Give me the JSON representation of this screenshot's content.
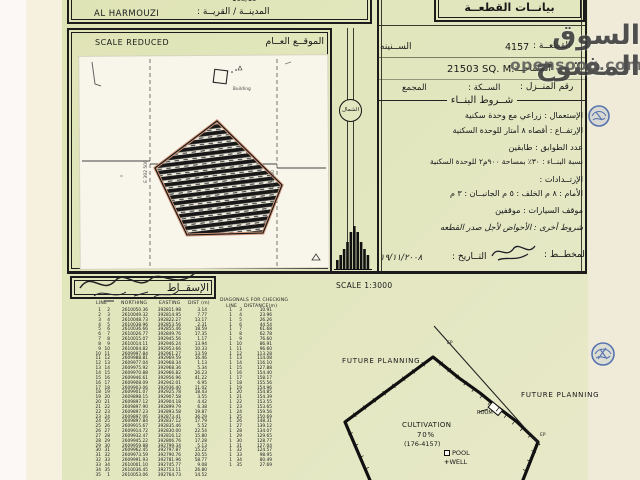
{
  "header_top": {
    "row1": {
      "wilaya_label": "الولايــة :",
      "map_no": "168/19",
      "map_no_label": "رقم الخريطــة :"
    },
    "row2": {
      "town_en": "AL HARMOUZI",
      "town_label": "المدينــة / القريــة :"
    }
  },
  "general_location": {
    "title_en": "SCALE REDUCED",
    "title_ar": "الموقــع العــام",
    "grid_e_left": "E 392 500",
    "grid_e_right": "E 393 000",
    "building_label": "Building"
  },
  "north_label": "الشمال",
  "plot_details": {
    "title": "بيانــات القطعــة",
    "village": "الســنينه",
    "plot_no": "4157",
    "plot_label": "القطعــة :",
    "area_label": "المساحــة :",
    "area_value": "21503 SQ. M.",
    "house_no_label": "رقم المنــزل :",
    "street_label": "الســكة :",
    "complex_label": "المجمع",
    "conditions_title": "شــروط البنــاء",
    "conditions": [
      "الإستعمال : زراعي مع وحدة سكنية",
      "الإرتفــاع : أقصاه ٨ أمتار للوحدة السكنية",
      "عدد الطوابق : طابقين",
      "نسبة البنــاء : ٣٠٪ بمساحة ٩٠٠م٢ للوحدة السكنية",
      "الإرتــدادات :",
      "الأمام : ٨ م    الخلف : ٥ م    الجانبــان : ٣ م",
      "موقف السيارات : موقفين",
      "شروط أخرى : الأحواض لأجل صدر القطعه"
    ],
    "planner_label": "المخطــط :",
    "date_label": "التــاريخ :",
    "date_value": "١٩/١١/٢٠٠٨"
  },
  "coordinates": {
    "title": "الإسقــاط",
    "headers": {
      "line": "LINE",
      "northing": "NORTHING",
      "easting": "EASTING",
      "dist": "DIST (m)",
      "diag_title": "DIAGONALS FOR CHECKING",
      "diag_line": "LINE",
      "diag_dist": "DISTANCE(m)"
    },
    "rows": [
      [
        "1",
        "2",
        "2610050.36",
        "392811.98",
        "3.14"
      ],
      [
        "2",
        "3",
        "2610049.32",
        "392814.95",
        "7.77"
      ],
      [
        "3",
        "4",
        "2610048.73",
        "392822.27",
        "13.17"
      ],
      [
        "4",
        "5",
        "2610038.96",
        "392853.56",
        "2.31"
      ],
      [
        "5",
        "6",
        "2610036.66",
        "392855.46",
        "18.59"
      ],
      [
        "6",
        "7",
        "2610026.77",
        "392849.76",
        "17.35"
      ],
      [
        "7",
        "8",
        "2610015.07",
        "392945.56",
        "1.17"
      ],
      [
        "8",
        "9",
        "2610014.11",
        "392946.24",
        "13.94"
      ],
      [
        "9",
        "10",
        "2610004.82",
        "392953.66",
        "10.33"
      ],
      [
        "10",
        "11",
        "2609997.84",
        "392961.27",
        "13.59"
      ],
      [
        "11",
        "12",
        "2609988.81",
        "392969.59",
        "16.46"
      ],
      [
        "12",
        "13",
        "2609977.04",
        "392968.34",
        "1.13"
      ],
      [
        "13",
        "14",
        "2609975.92",
        "392968.36",
        "5.34"
      ],
      [
        "14",
        "15",
        "2609970.88",
        "392966.82",
        "26.23"
      ],
      [
        "15",
        "16",
        "2609946.61",
        "392956.96",
        "41.22"
      ],
      [
        "16",
        "17",
        "2609908.09",
        "392942.01",
        "6.95"
      ],
      [
        "17",
        "18",
        "2609903.06",
        "392936.40",
        "11.02"
      ],
      [
        "18",
        "19",
        "2609901.07",
        "392925.78",
        "18.43"
      ],
      [
        "19",
        "20",
        "2609898.15",
        "392907.58",
        "3.55"
      ],
      [
        "20",
        "21",
        "2609897.12",
        "392904.18",
        "4.42"
      ],
      [
        "21",
        "22",
        "2609897.90",
        "392899.79",
        "6.38"
      ],
      [
        "22",
        "23",
        "2609897.23",
        "392893.58",
        "19.87"
      ],
      [
        "23",
        "24",
        "2609897.06",
        "392873.41",
        "36.29"
      ],
      [
        "24",
        "25",
        "2609897.84",
        "392837.12",
        "17.79"
      ],
      [
        "25",
        "26",
        "2609915.67",
        "392835.46",
        "5.52"
      ],
      [
        "26",
        "27",
        "2609914.72",
        "392830.00",
        "22.54"
      ],
      [
        "27",
        "28",
        "2609932.47",
        "392816.12",
        "15.80"
      ],
      [
        "28",
        "29",
        "2609945.22",
        "392806.76",
        "17.28"
      ],
      [
        "29",
        "30",
        "2609959.88",
        "392799.34",
        "5.13"
      ],
      [
        "30",
        "31",
        "2609962.45",
        "392797.87",
        "15.22"
      ],
      [
        "31",
        "32",
        "2609973.59",
        "392790.76",
        "20.55"
      ],
      [
        "32",
        "33",
        "2609991.93",
        "392781.96",
        "58.77"
      ],
      [
        "33",
        "34",
        "2610001.10",
        "392745.77",
        "9.08"
      ],
      [
        "34",
        "35",
        "2610036.45",
        "392753.11",
        "26.80"
      ],
      [
        "35",
        "1",
        "2610053.06",
        "392764.73",
        "14.52"
      ]
    ],
    "diagonals": [
      [
        "1",
        "3",
        "10.91"
      ],
      [
        "1",
        "4",
        "23.96"
      ],
      [
        "1",
        "5",
        "26.26"
      ],
      [
        "1",
        "6",
        "44.54"
      ],
      [
        "1",
        "7",
        "61.68"
      ],
      [
        "1",
        "8",
        "62.78"
      ],
      [
        "1",
        "9",
        "76.60"
      ],
      [
        "1",
        "10",
        "86.91"
      ],
      [
        "1",
        "11",
        "96.60"
      ],
      [
        "1",
        "12",
        "113.28"
      ],
      [
        "1",
        "13",
        "114.08"
      ],
      [
        "1",
        "14",
        "116.10"
      ],
      [
        "1",
        "15",
        "127.88"
      ],
      [
        "1",
        "16",
        "154.40"
      ],
      [
        "1",
        "17",
        "158.17"
      ],
      [
        "1",
        "18",
        "155.56"
      ],
      [
        "1",
        "19",
        "154.96"
      ],
      [
        "1",
        "20",
        "154.85"
      ],
      [
        "1",
        "21",
        "154.39"
      ],
      [
        "1",
        "22",
        "153.55"
      ],
      [
        "1",
        "23",
        "153.65"
      ],
      [
        "1",
        "24",
        "159.56"
      ],
      [
        "1",
        "25",
        "150.69"
      ],
      [
        "1",
        "26",
        "148.31"
      ],
      [
        "1",
        "27",
        "139.12"
      ],
      [
        "1",
        "28",
        "134.07"
      ],
      [
        "1",
        "29",
        "129.65"
      ],
      [
        "1",
        "30",
        "128.77"
      ],
      [
        "1",
        "31",
        "127.04"
      ],
      [
        "1",
        "32",
        "124.57"
      ],
      [
        "1",
        "33",
        "98.95"
      ],
      [
        "1",
        "34",
        "80.49"
      ],
      [
        "1",
        "35",
        "27.69"
      ]
    ]
  },
  "site_plan": {
    "scale": "SCALE 1:3000",
    "future_planning_left": "FUTURE PLANNING",
    "future_planning_right": "FUTURE PLANNING",
    "cultivation": "CULTIVATION",
    "cultivation_pct": "70%",
    "cultivation_ref": "(176-4157)",
    "pool": "POOL",
    "well": "WELL",
    "room": "ROOM",
    "ep1": "EP",
    "ep2": "EP"
  },
  "watermark": {
    "line1": "السوق المفتوح",
    "line2": "opensooq.com"
  },
  "colors": {
    "sheet": "#e0e5ba",
    "margin": "#efebd8",
    "map_paper": "#f8f5ea",
    "ink": "#1a1a1a",
    "stamp_blue": "#3d5fa8",
    "watermark_gray": "#3a3a3a"
  }
}
